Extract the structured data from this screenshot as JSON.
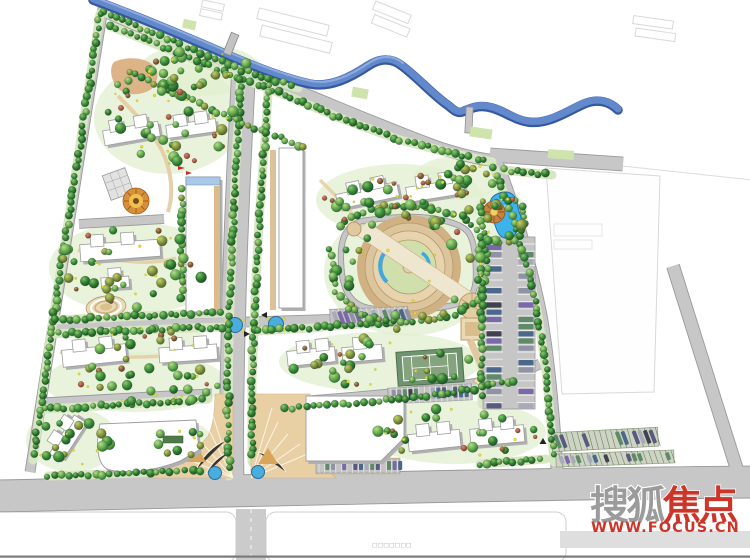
{
  "page": {
    "kind": "residential-community-master-plan-rendering",
    "width": 750,
    "height": 560
  },
  "watermark": {
    "brand_gray": "搜狐",
    "brand_red": "焦点",
    "url": "WWW.FOCUS.CN",
    "red": "#cc3528",
    "gray": "#9b9b9b"
  },
  "caption": {
    "text": "□□□□□□□"
  },
  "colors": {
    "road_gray": "#c7c7c7",
    "road_casing": "#9a9a9a",
    "river_blue": "#6289cc",
    "river_dark": "#35589e",
    "pond_blue": "#3db3ec",
    "tree_dark_green": "#2f7a33",
    "lawn_green": "#e2efcf",
    "plaza_tan": "#e9d0a4",
    "building_white": "#ffffff",
    "building_shadow": "#b0b0b0",
    "context_line": "#d8d8d8"
  }
}
